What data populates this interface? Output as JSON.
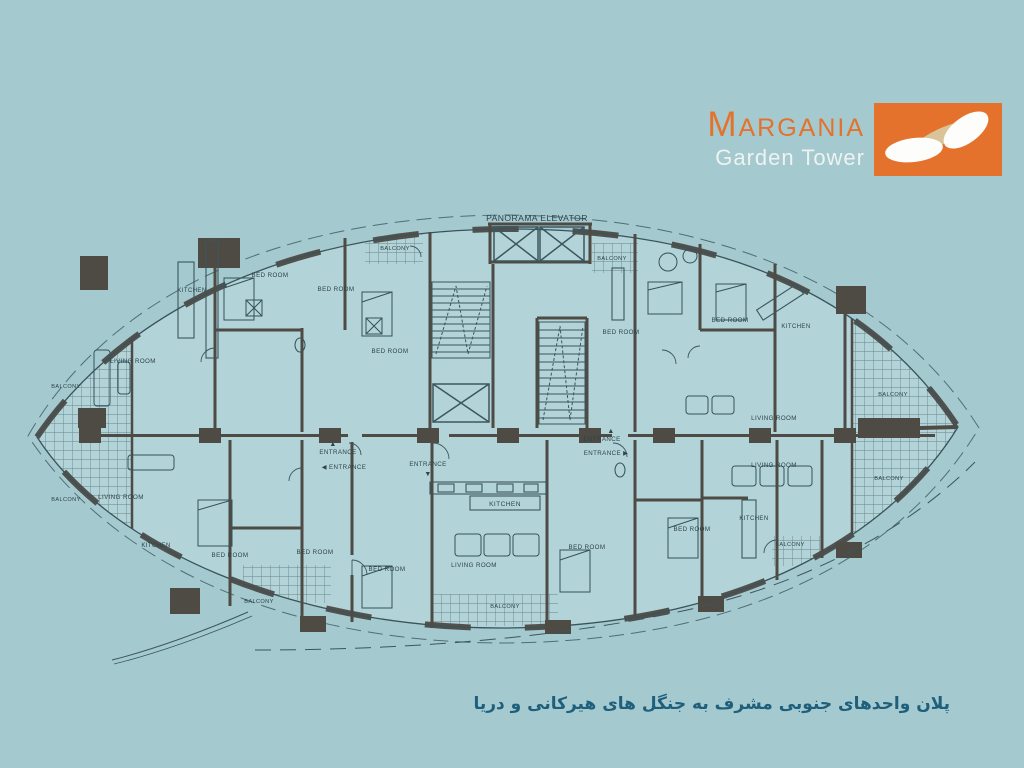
{
  "page": {
    "background": "#a4c9cf"
  },
  "logo": {
    "title": "Margania",
    "subtitle": "Garden Tower",
    "accent_orange": "#e4722c",
    "mark_icon": "twin-leaf-mark"
  },
  "plan": {
    "wall_color": "#4e4a44",
    "line_color": "#3c565e",
    "label_color": "#2e434a",
    "labels": [
      {
        "text": "PANORAMA ELEVATOR",
        "x": 537,
        "y": 221,
        "size": 8.6
      },
      {
        "text": "BALCONY",
        "x": 395,
        "y": 250,
        "size": 5.6
      },
      {
        "text": "BALCONY",
        "x": 612,
        "y": 260,
        "size": 5.6
      },
      {
        "text": "KITCHEN",
        "x": 192,
        "y": 292,
        "size": 6
      },
      {
        "text": "BED ROOM",
        "x": 270,
        "y": 277,
        "size": 6.2
      },
      {
        "text": "BED ROOM",
        "x": 336,
        "y": 291,
        "size": 6.2
      },
      {
        "text": "BED ROOM",
        "x": 390,
        "y": 353,
        "size": 6.2
      },
      {
        "text": "LIVING ROOM",
        "x": 133,
        "y": 363,
        "size": 6.2
      },
      {
        "text": "BALCONY",
        "x": 66,
        "y": 388,
        "size": 5.6
      },
      {
        "text": "BALCONY",
        "x": 66,
        "y": 501,
        "size": 5.6
      },
      {
        "text": "LIVING ROOM",
        "x": 121,
        "y": 499,
        "size": 6.2
      },
      {
        "text": "KITCHEN",
        "x": 156,
        "y": 547,
        "size": 6
      },
      {
        "text": "BED ROOM",
        "x": 230,
        "y": 557,
        "size": 6.2
      },
      {
        "text": "BED ROOM",
        "x": 315,
        "y": 554,
        "size": 6.2
      },
      {
        "text": "BALCONY",
        "x": 259,
        "y": 603,
        "size": 5.6
      },
      {
        "text": "BED ROOM",
        "x": 387,
        "y": 571,
        "size": 6.2
      },
      {
        "text": "▲",
        "x": 333,
        "y": 446,
        "size": 7
      },
      {
        "text": "ENTRANCE",
        "x": 338,
        "y": 454,
        "size": 6.2
      },
      {
        "text": "◀ ENTRANCE",
        "x": 344,
        "y": 469,
        "size": 6.2
      },
      {
        "text": "ENTRANCE",
        "x": 428,
        "y": 466,
        "size": 6.2
      },
      {
        "text": "▼",
        "x": 428,
        "y": 476,
        "size": 7
      },
      {
        "text": "▲",
        "x": 611,
        "y": 433,
        "size": 7
      },
      {
        "text": "ENTRANCE",
        "x": 602,
        "y": 441,
        "size": 6.2
      },
      {
        "text": "ENTRANCE ▶",
        "x": 606,
        "y": 455,
        "size": 6.2
      },
      {
        "text": "KITCHEN",
        "x": 505,
        "y": 506,
        "size": 6.6
      },
      {
        "text": "LIVING ROOM",
        "x": 474,
        "y": 567,
        "size": 6.2
      },
      {
        "text": "BALCONY",
        "x": 505,
        "y": 608,
        "size": 5.6
      },
      {
        "text": "BED ROOM",
        "x": 587,
        "y": 549,
        "size": 6.2
      },
      {
        "text": "BED ROOM",
        "x": 621,
        "y": 334,
        "size": 6.2
      },
      {
        "text": "BED ROOM",
        "x": 730,
        "y": 322,
        "size": 6.2
      },
      {
        "text": "KITCHEN",
        "x": 796,
        "y": 328,
        "size": 6
      },
      {
        "text": "LIVING ROOM",
        "x": 774,
        "y": 420,
        "size": 6.2
      },
      {
        "text": "LIVING ROOM",
        "x": 774,
        "y": 467,
        "size": 6.2
      },
      {
        "text": "BED ROOM",
        "x": 692,
        "y": 531,
        "size": 6.2
      },
      {
        "text": "KITCHEN",
        "x": 754,
        "y": 520,
        "size": 6
      },
      {
        "text": "BALCONY",
        "x": 790,
        "y": 546,
        "size": 5.6
      },
      {
        "text": "BALCONY",
        "x": 893,
        "y": 396,
        "size": 5.6
      },
      {
        "text": "BALCONY",
        "x": 889,
        "y": 480,
        "size": 5.6
      }
    ]
  },
  "caption": {
    "text": "پلان واحدهای جنوبی مشرف به جنگل های هیرکانی و دریا",
    "color": "#1e5f7c"
  }
}
